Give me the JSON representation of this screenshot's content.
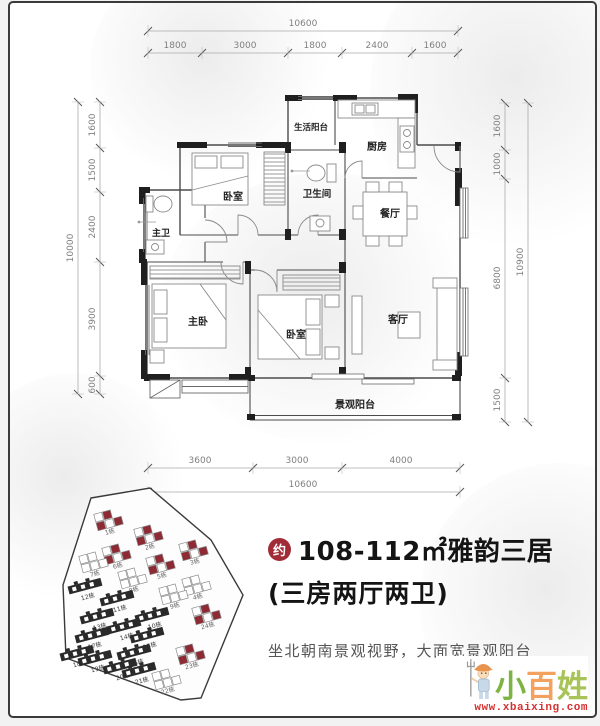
{
  "floor_plan": {
    "rooms": [
      {
        "name": "service-balcony",
        "label": "生活阳台"
      },
      {
        "name": "kitchen",
        "label": "厨房"
      },
      {
        "name": "bathroom",
        "label": "卫生间"
      },
      {
        "name": "dining-room",
        "label": "餐厅"
      },
      {
        "name": "bedroom-north",
        "label": "卧室"
      },
      {
        "name": "master-bathroom",
        "label": "主卫"
      },
      {
        "name": "master-bedroom",
        "label": "主卧"
      },
      {
        "name": "bedroom-middle",
        "label": "卧室"
      },
      {
        "name": "living-room",
        "label": "客厅"
      },
      {
        "name": "view-balcony",
        "label": "景观阳台"
      }
    ],
    "dimensions": {
      "top": {
        "total": "10600",
        "segments": [
          "1800",
          "3000",
          "1800",
          "2400",
          "1600"
        ]
      },
      "bottom": {
        "total": "10600",
        "segments": [
          "3600",
          "3000",
          "4000"
        ]
      },
      "left": {
        "total": "10000",
        "segments": [
          "1600",
          "1500",
          "2400",
          "3900",
          "600"
        ]
      },
      "right": {
        "total": "10900",
        "segments": [
          "1600",
          "1000",
          "6800",
          "1500"
        ]
      }
    }
  },
  "site_plan": {
    "highlight_color": "#8e2a34",
    "buildings": [
      {
        "label": "1栋",
        "x": 58,
        "y": 40,
        "type": "tower-red"
      },
      {
        "label": "2栋",
        "x": 98,
        "y": 55,
        "type": "tower-red"
      },
      {
        "label": "3栋",
        "x": 143,
        "y": 70,
        "type": "tower-red"
      },
      {
        "label": "6栋",
        "x": 66,
        "y": 74,
        "type": "tower-red"
      },
      {
        "label": "5栋",
        "x": 110,
        "y": 84,
        "type": "tower-red"
      },
      {
        "label": "7栋",
        "x": 43,
        "y": 82,
        "type": "tower"
      },
      {
        "label": "8栋",
        "x": 82,
        "y": 98,
        "type": "tower"
      },
      {
        "label": "4栋",
        "x": 146,
        "y": 105,
        "type": "tower"
      },
      {
        "label": "9栋",
        "x": 123,
        "y": 114,
        "type": "tower"
      },
      {
        "label": "12栋",
        "x": 36,
        "y": 105,
        "type": "slab"
      },
      {
        "label": "11栋",
        "x": 68,
        "y": 117,
        "type": "slab"
      },
      {
        "label": "13栋",
        "x": 48,
        "y": 135,
        "type": "slab"
      },
      {
        "label": "10栋",
        "x": 103,
        "y": 134,
        "type": "slab"
      },
      {
        "label": "14栋",
        "x": 75,
        "y": 145,
        "type": "slab"
      },
      {
        "label": "17栋",
        "x": 43,
        "y": 154,
        "type": "slab"
      },
      {
        "label": "15栋",
        "x": 98,
        "y": 154,
        "type": "slab"
      },
      {
        "label": "16栋",
        "x": 85,
        "y": 171,
        "type": "slab"
      },
      {
        "label": "18栋",
        "x": 28,
        "y": 172,
        "type": "slab"
      },
      {
        "label": "19栋",
        "x": 46,
        "y": 177,
        "type": "slab"
      },
      {
        "label": "20栋",
        "x": 71,
        "y": 185,
        "type": "slab"
      },
      {
        "label": "21栋",
        "x": 90,
        "y": 189,
        "type": "slab"
      },
      {
        "label": "24栋",
        "x": 156,
        "y": 134,
        "type": "tower-red"
      },
      {
        "label": "23栋",
        "x": 140,
        "y": 174,
        "type": "tower-red"
      },
      {
        "label": "22栋",
        "x": 116,
        "y": 199,
        "type": "tower"
      }
    ]
  },
  "listing": {
    "badge": "约",
    "title_line1": "108-112㎡雅韵三居",
    "title_line2": "(三房两厅两卫)",
    "tagline": "坐北朝南景观视野，大面宽景观阳台",
    "accent_color": "#a12c38"
  },
  "watermark": {
    "chars": [
      "小",
      "百",
      "姓"
    ],
    "url": "www.xbaixing.com"
  }
}
